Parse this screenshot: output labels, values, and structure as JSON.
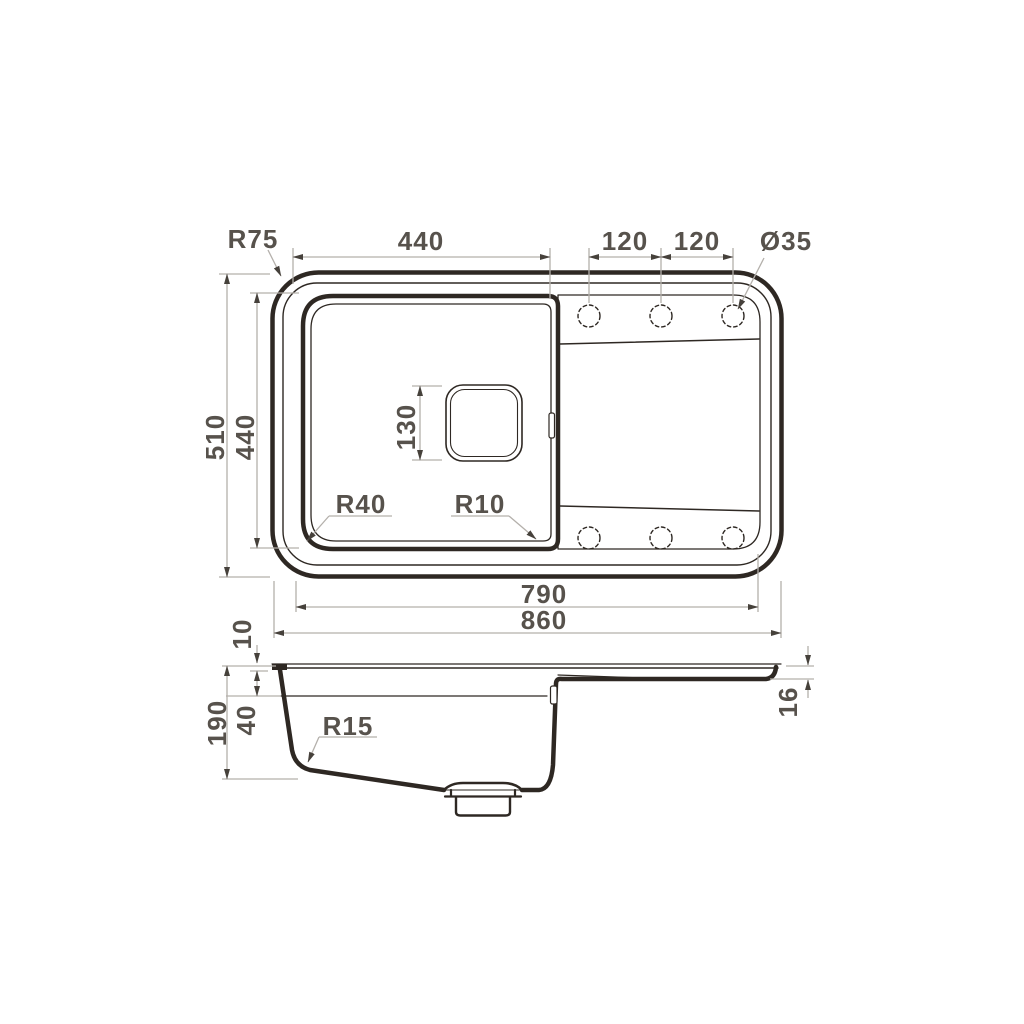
{
  "drawing": {
    "description": "Kitchen sink dimensional drawing with top view and side section view",
    "views": [
      "top",
      "side"
    ],
    "tap_holes": {
      "count": 6,
      "diameter_label": "Ø35"
    }
  },
  "colors": {
    "background": "#ffffff",
    "outline": "#2e2823",
    "dimension_line": "#b4b0ab",
    "arrowhead": "#46413b",
    "label": "#57524c"
  },
  "annotations": [
    {
      "id": "corner-radius",
      "text": "R75",
      "x": 253,
      "y": 248,
      "rotate": 0
    },
    {
      "id": "bowl-outer-width",
      "text": "440",
      "x": 421,
      "y": 250,
      "rotate": 0
    },
    {
      "id": "hole-spacing-left",
      "text": "120",
      "x": 625,
      "y": 250,
      "rotate": 0
    },
    {
      "id": "hole-spacing-right",
      "text": "120",
      "x": 697,
      "y": 250,
      "rotate": 0
    },
    {
      "id": "hole-diameter",
      "text": "Ø35",
      "x": 786,
      "y": 250,
      "rotate": 0
    },
    {
      "id": "overall-depth",
      "text": "510",
      "x": 224,
      "y": 437,
      "rotate": -90
    },
    {
      "id": "bowl-outer-depth",
      "text": "440",
      "x": 254,
      "y": 437,
      "rotate": -90
    },
    {
      "id": "drain-size",
      "text": "130",
      "x": 415,
      "y": 427,
      "rotate": -90
    },
    {
      "id": "bowl-corner-radius-left",
      "text": "R40",
      "x": 361,
      "y": 513,
      "rotate": 0
    },
    {
      "id": "bowl-corner-radius-right",
      "text": "R10",
      "x": 480,
      "y": 513,
      "rotate": 0
    },
    {
      "id": "bowl-panel-width",
      "text": "790",
      "x": 544,
      "y": 603,
      "rotate": 0
    },
    {
      "id": "overall-width",
      "text": "860",
      "x": 544,
      "y": 629,
      "rotate": 0
    },
    {
      "id": "rim-height",
      "text": "10",
      "x": 251,
      "y": 634,
      "rotate": -90
    },
    {
      "id": "overall-height",
      "text": "190",
      "x": 226,
      "y": 723,
      "rotate": -90
    },
    {
      "id": "ledge-depth",
      "text": "40",
      "x": 255,
      "y": 720,
      "rotate": -90
    },
    {
      "id": "bowl-bottom-radius",
      "text": "R15",
      "x": 348,
      "y": 735,
      "rotate": 0
    },
    {
      "id": "drainboard-thickness",
      "text": "16",
      "x": 797,
      "y": 702,
      "rotate": -90
    }
  ]
}
